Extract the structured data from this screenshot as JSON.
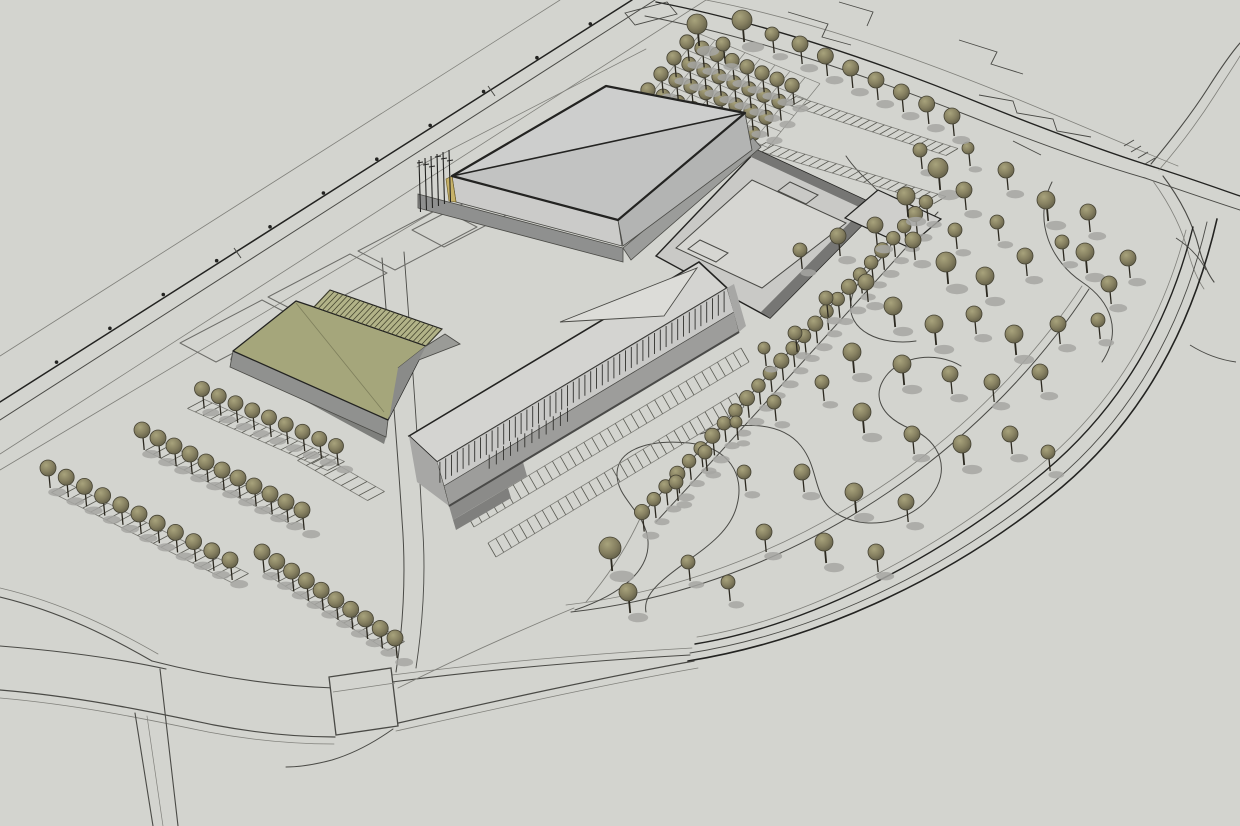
{
  "scene": {
    "kind": "3d-architectural-site-massing-model",
    "colors": {
      "ground": "#d3d4cf",
      "line_soft": "#80807b",
      "line_mid": "#4a4a46",
      "line_dark": "#232321",
      "stripe": "#5a5a53",
      "panel": "#6e6e6a",
      "arena_roof_l": "#cdcecd",
      "arena_roof_d": "#c2c3c2",
      "arena_wall_l": "#cbcbc9",
      "arena_wall_d": "#b3b4b3",
      "plinth": "#8f908f",
      "plinth2": "#9b9c9a",
      "accent": "#c7b269",
      "office_roof": "#d4d4d1",
      "office_face": "#c9c9c7",
      "office_band": "#9d9d9b",
      "office_band2": "#8b8b89",
      "office_end": "#a7a7a5",
      "louver": "#30302d",
      "sky": "#dcdcd8",
      "podium_slab": "#c9c9c6",
      "podium_wall": "#767674",
      "podium_floor": "#d6d6d2",
      "annex": "#cfcfcc",
      "olive": "#a5a67b",
      "olive_hatch_bg": "#b2b388",
      "olive_hatch_ln": "#45452f",
      "olive_base": "#90918f",
      "olive_base2": "#7e7f7c",
      "olive_wedge": "#9a9b97",
      "olive_dark": "#8a8b89",
      "tree_hi": "#a8a37c",
      "tree_mid": "#857f60",
      "tree_dark": "#5d5a45",
      "tree_stroke": "#454233",
      "tree_trunk": "#2c2920",
      "tree_shadow": "#a6a6a2"
    },
    "roads": [
      {
        "d": "M0,356 L560,0",
        "w": 0.8,
        "c": "line_soft"
      },
      {
        "d": "M0,402 L632,0",
        "w": 1.5,
        "c": "line_dark"
      },
      {
        "d": "M0,420 L655,0",
        "w": 1.0,
        "c": "line_mid"
      },
      {
        "d": "M0,454 L706,0",
        "w": 0.8,
        "c": "line_soft"
      },
      {
        "d": "M0,470 L433,212",
        "w": 0.8,
        "c": "line_soft"
      },
      {
        "d": "M417,167 L646,49",
        "w": 0.8,
        "c": "line_soft"
      },
      {
        "d": "M656,2 C770,24 884,64 982,104 C1062,136 1122,157 1154,167",
        "w": 1.4,
        "c": "line_dark"
      },
      {
        "d": "M645,16 C760,38 872,78 972,117 C1050,148 1110,168 1145,178",
        "w": 1.0,
        "c": "line_mid"
      },
      {
        "d": "M706,0 C810,20 910,56 1000,92 C1078,124 1138,150 1178,166",
        "w": 0.8,
        "c": "line_soft"
      },
      {
        "d": "M1154,167 C1186,177 1214,187 1240,196",
        "w": 1.3,
        "c": "line_dark"
      },
      {
        "d": "M1145,178 C1180,190 1212,201 1240,210",
        "w": 1.0,
        "c": "line_mid"
      },
      {
        "d": "M1151,164 C1176,134 1194,110 1208,88 C1222,66 1233,51 1240,43",
        "w": 1.1,
        "c": "line_mid"
      },
      {
        "d": "M1159,170 C1184,141 1201,117 1215,95 C1227,76 1236,63 1240,56",
        "w": 0.8,
        "c": "line_soft"
      },
      {
        "d": "M1163,176 C1181,200 1193,224 1199,248 C1203,263 1208,274 1214,282",
        "w": 1.1,
        "c": "line_mid"
      },
      {
        "d": "M1153,181 C1171,206 1183,231 1189,255 C1193,269 1198,280 1204,289",
        "w": 0.8,
        "c": "line_soft"
      },
      {
        "d": "M688,661 C806,642 944,585 1062,487 C1142,419 1192,328 1217,219",
        "w": 1.6,
        "c": "line_dark"
      },
      {
        "d": "M690,653 C804,635 938,578 1054,482 C1132,416 1182,329 1207,222",
        "w": 0.9,
        "c": "line_mid"
      },
      {
        "d": "M695,644 C800,627 930,566 1044,472 C1120,408 1168,327 1193,227",
        "w": 1.4,
        "c": "line_dark"
      },
      {
        "d": "M697,637 C798,621 926,560 1038,467 C1113,405 1161,325 1186,230",
        "w": 0.8,
        "c": "line_soft"
      },
      {
        "d": "M571,612 C686,599 806,554 914,474 C992,416 1050,349 1089,289",
        "w": 1.0,
        "c": "line_mid"
      },
      {
        "d": "M566,605 C680,592 800,547 908,468 C985,411 1043,345 1082,286",
        "w": 0.8,
        "c": "line_soft"
      },
      {
        "d": "M0,597 C62,612 112,638 152,661",
        "w": 1.1,
        "c": "line_mid"
      },
      {
        "d": "M0,588 C64,603 116,630 158,654",
        "w": 0.8,
        "c": "line_soft"
      },
      {
        "d": "M0,646 C62,651 120,659 166,669",
        "w": 1.1,
        "c": "line_mid"
      },
      {
        "d": "M152,661 C222,679 282,686 334,688",
        "w": 1.1,
        "c": "line_mid"
      },
      {
        "d": "M0,690 C84,697 156,713 214,725 C262,734 300,737 335,737",
        "w": 1.2,
        "c": "line_mid"
      },
      {
        "d": "M0,698 C80,705 150,720 208,732 C256,741 298,744 334,744",
        "w": 0.8,
        "c": "line_soft"
      },
      {
        "d": "M392,682 C486,670 584,661 690,655",
        "w": 1.1,
        "c": "line_mid"
      },
      {
        "d": "M392,675 C488,663 586,654 692,648",
        "w": 0.7,
        "c": "line_soft"
      },
      {
        "d": "M394,724 C500,700 600,678 694,661",
        "w": 1.2,
        "c": "line_mid"
      },
      {
        "d": "M396,731 C504,707 606,684 698,668",
        "w": 0.8,
        "c": "line_soft"
      },
      {
        "d": "M135,713 L153,826",
        "w": 1.1,
        "c": "line_mid"
      },
      {
        "d": "M160,669 L178,826",
        "w": 1.1,
        "c": "line_mid"
      },
      {
        "d": "M147,716 L163,826",
        "w": 0.7,
        "c": "line_soft"
      },
      {
        "d": "M393,729 C372,744 352,754 332,760 C313,765 298,767 286,767",
        "w": 1.0,
        "c": "line_mid"
      },
      {
        "d": "M382,258 C390,360 397,440 402,520 C406,570 404,620 396,672",
        "w": 1.0,
        "c": "line_mid"
      },
      {
        "d": "M404,252 C412,360 418,440 422,520 C426,566 424,615 416,668",
        "w": 0.9,
        "c": "line_mid"
      },
      {
        "d": "M398,688 C470,652 540,622 574,608",
        "w": 0.9,
        "c": "line_soft"
      },
      {
        "d": "M642,514 Q786,356 924,202",
        "w": 1.0,
        "c": "line_mid"
      },
      {
        "d": "M656,522 Q800,366 938,212",
        "w": 1.0,
        "c": "line_mid"
      },
      {
        "d": "M642,514 C628,546 608,576 586,602",
        "w": 0.9,
        "c": "line_soft"
      },
      {
        "d": "M575,610 C622,594 650,570 648,541 C646,512 616,499 617,473 C618,449 650,439 689,443 C729,447 745,475 737,505 C729,539 690,556 663,580 C649,592 644,602 646,612",
        "w": 1.0,
        "c": "line_mid"
      },
      {
        "d": "M700,434 C741,421 781,421 801,446 C821,471 811,501 841,516 C871,531 911,521 931,496 C951,471 941,441 911,429 C881,417 871,396 886,376 C901,356 936,351 961,366",
        "w": 1.0,
        "c": "line_mid"
      },
      {
        "d": "M846,156 C866,186 901,201 896,231 C891,261 856,271 851,301 C846,331 881,346 916,341",
        "w": 1.0,
        "c": "line_mid"
      },
      {
        "d": "M1052,182 C1032,222 1052,262 1082,282 C1112,302 1122,332 1102,362",
        "w": 1.0,
        "c": "line_mid"
      }
    ],
    "decor": [
      {
        "d": "M625,13 L667,2 L677,14 L635,25 Z",
        "w": 0.9
      },
      {
        "d": "M788,12 L828,24 L822,37 L851,45",
        "w": 0.9
      },
      {
        "d": "M839,2 L873,12 L867,26",
        "w": 0.9
      },
      {
        "d": "M959,40 L997,52 L991,64 L1023,74",
        "w": 0.9
      },
      {
        "d": "M979,95 L1013,101 L1017,113 L1053,119 L1057,131 L1091,137",
        "w": 0.9
      },
      {
        "d": "M1013,141 L1041,155",
        "w": 0.9
      },
      {
        "d": "M1124,146 l10,-6 M1131,152 l10,-6 M1138,158 l10,-6 M1145,164 l10,-6",
        "w": 1.0
      },
      {
        "d": "M1190,345 C1206,355 1221,360 1236,362",
        "w": 0.9
      },
      {
        "d": "M1176,238 C1190,247 1200,258 1206,270",
        "w": 0.9
      },
      {
        "d": "M234,248 l7,10 M488,86 l7,10",
        "w": 1.0
      }
    ],
    "lamps": {
      "x1": 0,
      "y1": 398,
      "x2": 628,
      "y2": 0,
      "t": [
        0.09,
        0.175,
        0.26,
        0.345,
        0.43,
        0.515,
        0.6,
        0.685,
        0.77,
        0.855,
        0.94
      ],
      "r": 1.8
    },
    "panels": [
      [
        180,
        343,
        262,
        300,
        298,
        319,
        216,
        362
      ],
      [
        268,
        297,
        350,
        254,
        387,
        273,
        305,
        316
      ],
      [
        358,
        251,
        440,
        208,
        477,
        227,
        395,
        270
      ],
      [
        412,
        230,
        478,
        196,
        510,
        213,
        444,
        247
      ]
    ],
    "bands": [
      {
        "p": [
          196,
          404,
          336,
          466
        ],
        "dir": [
          17,
          -9
        ],
        "gap": 8.5
      },
      {
        "p": [
          154,
          446,
          300,
          520
        ],
        "dir": [
          17,
          -9
        ],
        "gap": 8.5
      },
      {
        "p": [
          60,
          488,
          240,
          578
        ],
        "dir": [
          17,
          -9
        ],
        "gap": 8.5
      },
      {
        "p": [
          272,
          568,
          396,
          646
        ],
        "dir": [
          17,
          -9
        ],
        "gap": 8.5
      },
      {
        "p": [
          306,
          456,
          376,
          496
        ],
        "dir": [
          17,
          -9
        ],
        "gap": 9
      },
      {
        "p": [
          470,
          520,
          745,
          355
        ],
        "dir": [
          8,
          14
        ],
        "gap": 9
      },
      {
        "p": [
          492,
          550,
          740,
          400
        ],
        "dir": [
          8,
          14
        ],
        "gap": 9
      },
      {
        "p": [
          790,
          100,
          952,
          152
        ],
        "dir": [
          12,
          -7
        ],
        "gap": 7.5
      },
      {
        "p": [
          760,
          146,
          940,
          200
        ],
        "dir": [
          12,
          -7
        ],
        "gap": 8
      }
    ],
    "trees": {
      "rows": [
        {
          "line": [
            202,
            389,
            336,
            446
          ],
          "n": 9,
          "r": 7.5
        },
        {
          "line": [
            142,
            430,
            302,
            510
          ],
          "n": 11,
          "r": 8
        },
        {
          "line": [
            48,
            468,
            230,
            560
          ],
          "n": 11,
          "r": 8
        },
        {
          "line": [
            262,
            552,
            395,
            638
          ],
          "n": 10,
          "r": 8
        },
        {
          "line": [
            800,
            44,
            952,
            116
          ],
          "n": 7,
          "r": 8
        }
      ],
      "bosque": {
        "origin": [
          648,
          90
        ],
        "col": [
          15,
          6.2
        ],
        "cols": 8,
        "row": [
          13,
          -16
        ],
        "rows": 4,
        "r": 7.2
      },
      "extras": [
        [
          697,
          24,
          10
        ],
        [
          742,
          20,
          10
        ],
        [
          723,
          44,
          7
        ],
        [
          772,
          34,
          7
        ],
        [
          920,
          150,
          7
        ],
        [
          968,
          148,
          6
        ]
      ],
      "allee": {
        "p0": [
          642,
          512
        ],
        "p1": [
          790,
          352
        ],
        "p2": [
          926,
          202
        ],
        "n": 26,
        "r": 6.8
      },
      "park": [
        [
          938,
          168,
          10
        ],
        [
          906,
          196,
          9
        ],
        [
          964,
          190,
          8
        ],
        [
          1006,
          170,
          8
        ],
        [
          1046,
          200,
          9
        ],
        [
          1088,
          212,
          8
        ],
        [
          875,
          225,
          8
        ],
        [
          838,
          236,
          8
        ],
        [
          800,
          250,
          7
        ],
        [
          913,
          240,
          8
        ],
        [
          955,
          230,
          7
        ],
        [
          997,
          222,
          7
        ],
        [
          1085,
          252,
          9
        ],
        [
          1128,
          258,
          8
        ],
        [
          946,
          262,
          10
        ],
        [
          985,
          276,
          9
        ],
        [
          1025,
          256,
          8
        ],
        [
          1062,
          242,
          7
        ],
        [
          1109,
          284,
          8
        ],
        [
          866,
          282,
          8
        ],
        [
          826,
          298,
          7
        ],
        [
          893,
          306,
          9
        ],
        [
          934,
          324,
          9
        ],
        [
          974,
          314,
          8
        ],
        [
          1014,
          334,
          9
        ],
        [
          1058,
          324,
          8
        ],
        [
          1098,
          320,
          7
        ],
        [
          795,
          333,
          7
        ],
        [
          764,
          348,
          6
        ],
        [
          852,
          352,
          9
        ],
        [
          902,
          364,
          9
        ],
        [
          950,
          374,
          8
        ],
        [
          992,
          382,
          8
        ],
        [
          1040,
          372,
          8
        ],
        [
          822,
          382,
          7
        ],
        [
          774,
          402,
          7
        ],
        [
          736,
          422,
          6
        ],
        [
          862,
          412,
          9
        ],
        [
          912,
          434,
          8
        ],
        [
          962,
          444,
          9
        ],
        [
          1010,
          434,
          8
        ],
        [
          1048,
          452,
          7
        ],
        [
          705,
          452,
          7
        ],
        [
          676,
          482,
          7
        ],
        [
          744,
          472,
          7
        ],
        [
          802,
          472,
          8
        ],
        [
          854,
          492,
          9
        ],
        [
          906,
          502,
          8
        ],
        [
          764,
          532,
          8
        ],
        [
          824,
          542,
          9
        ],
        [
          876,
          552,
          8
        ],
        [
          688,
          562,
          7
        ],
        [
          728,
          582,
          7
        ],
        [
          610,
          548,
          11
        ],
        [
          628,
          592,
          9
        ]
      ]
    },
    "office": {
      "top": [
        437,
        462,
        727,
        288
      ],
      "louver_len": 21,
      "louvers": 50,
      "patch": {
        "t0": 0.18,
        "t1": 0.45,
        "n": 12,
        "len": 14
      }
    },
    "olive_hatch": {
      "a": [
        330,
        290,
        442,
        329
      ],
      "b": [
        314,
        307,
        426,
        346
      ],
      "n": 26
    },
    "flagpoles": {
      "x0": 419,
      "step": 6,
      "n": 6,
      "top": 160,
      "h": 52
    },
    "bosque_lattice": {
      "origin": [
        648,
        98
      ],
      "col": [
        15,
        6.2
      ],
      "cols": 8,
      "row": [
        13,
        -16
      ],
      "rows": 4
    }
  }
}
